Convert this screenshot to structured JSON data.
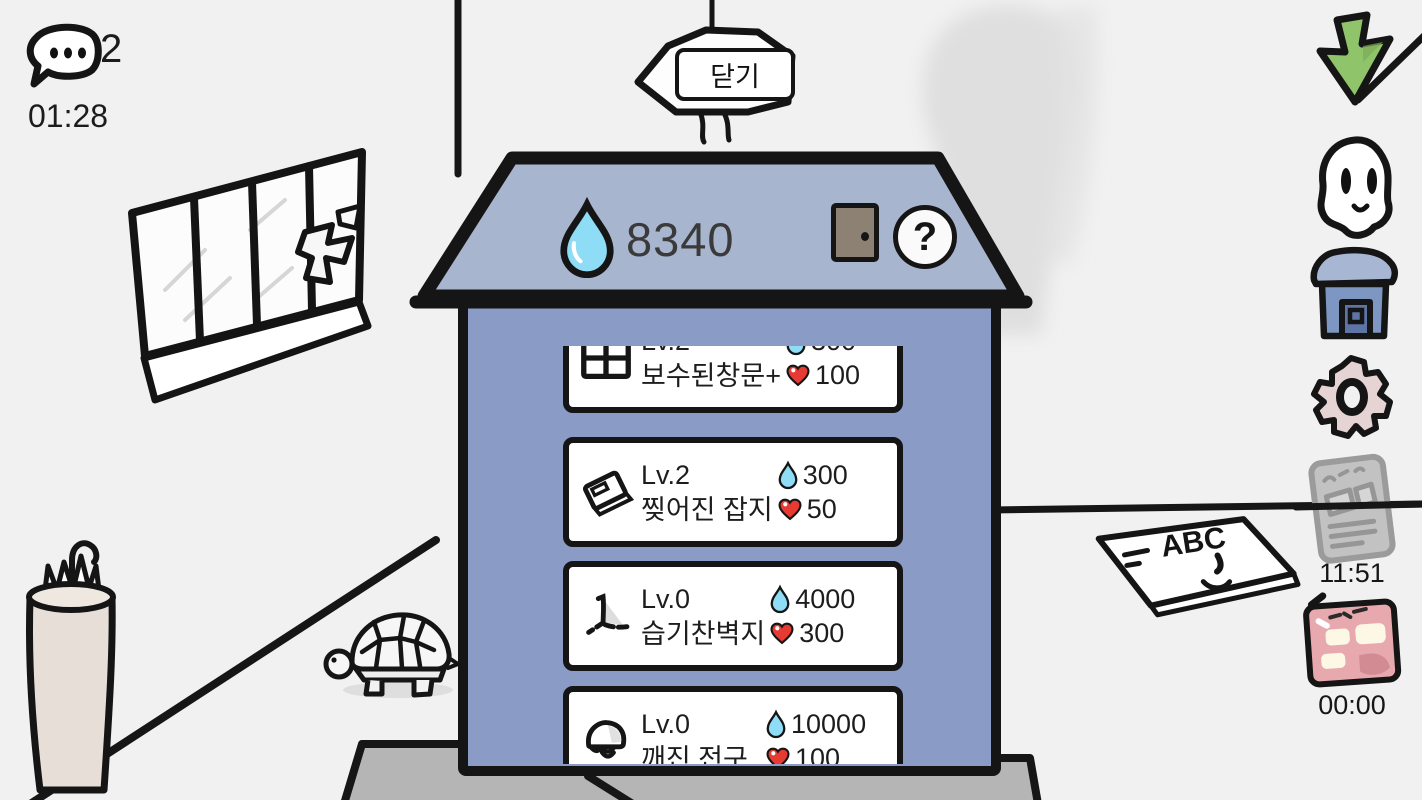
{
  "hud": {
    "chat_count": "2",
    "chat_timer": "01:28",
    "close_label": "닫기"
  },
  "shop": {
    "water_balance": "8340",
    "help_label": "?",
    "items": [
      {
        "icon": "window-icon",
        "level": "Lv.2",
        "name": "보수된창문+",
        "water_cost": "300",
        "heart_cost": "100"
      },
      {
        "icon": "magazine-icon",
        "level": "Lv.2",
        "name": "찢어진 잡지",
        "water_cost": "300",
        "heart_cost": "50"
      },
      {
        "icon": "wallpaper-icon",
        "level": "Lv.0",
        "name": "습기찬벽지",
        "water_cost": "4000",
        "heart_cost": "300"
      },
      {
        "icon": "bulb-icon",
        "level": "Lv.0",
        "name": "깨진 전구",
        "water_cost": "10000",
        "heart_cost": "100"
      }
    ]
  },
  "sidebar": {
    "news_timer": "11:51",
    "calendar_timer": "00:00",
    "icons": [
      "green-arrow-icon",
      "ghost-icon",
      "house-icon",
      "gear-icon",
      "news-icon",
      "calendar-icon"
    ]
  },
  "background": {
    "magazine_label": "ABC",
    "props": [
      "window",
      "hanging-lamp",
      "smoke",
      "umbrella-stand",
      "turtle",
      "magazine",
      "table"
    ]
  },
  "colors": {
    "roof": "#a8b5ce",
    "house": "#8a9cc5",
    "water": "#8edcf5",
    "heart": "#e63a33",
    "door": "#8d8174",
    "green": "#90c46b",
    "gearpink": "#e6d3d3",
    "calpink": "#e7a9ae",
    "gray": "#c2c2c2",
    "bg": "#f1f1f2",
    "ink": "#151515"
  }
}
